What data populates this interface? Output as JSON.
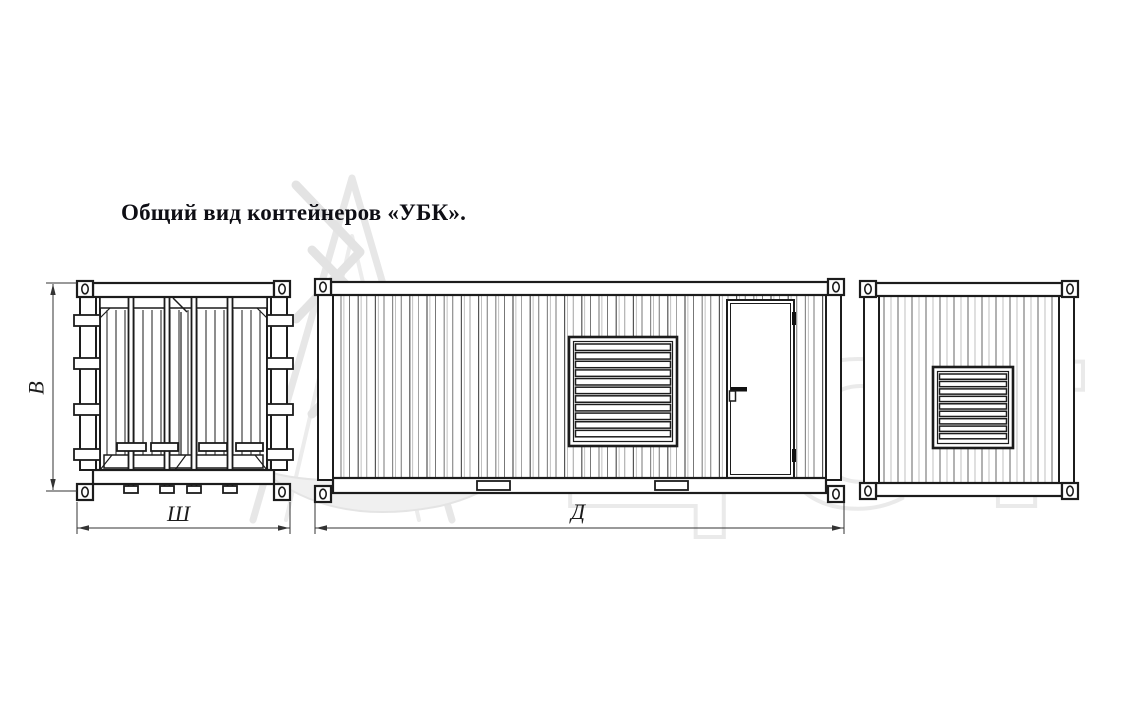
{
  "title": "Общий вид контейнеров «УБК».",
  "dimensions": {
    "height": "В",
    "width": "Ш",
    "length": "Д"
  },
  "watermark": {
    "text": "ЦСТ"
  },
  "figure": {
    "end_view_doors": {
      "lock_rods": 4,
      "hinge_blocks_per_side": 4
    },
    "side_view": {
      "louver_slats": 11,
      "door": true,
      "bottom_plates": 2
    },
    "end_view_grille": {
      "louver_slats": 9
    }
  },
  "colors": {
    "line": "#1c1c1c",
    "dimension": "#333333",
    "watermark": "#e5e5e5",
    "background": "#ffffff"
  }
}
